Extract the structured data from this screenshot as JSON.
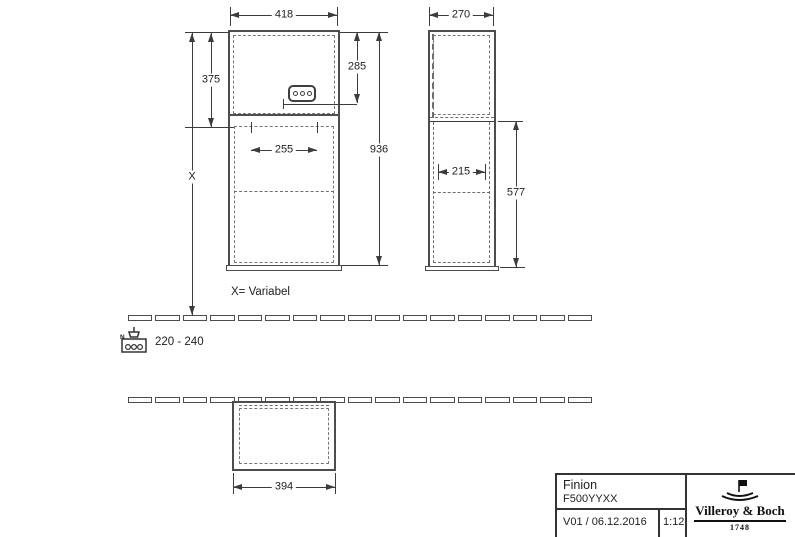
{
  "drawing": {
    "front_view": {
      "width": "418",
      "upper_section_height": "375",
      "socket_height": "285",
      "inner_width": "255",
      "total_height": "936",
      "variable_height": "X"
    },
    "side_view": {
      "depth": "270",
      "inner_depth": "215",
      "lower_section_height": "577"
    },
    "plan_view": {
      "width": "394"
    },
    "notes": {
      "variable_note": "X= Variabel",
      "voltage_range": "220 - 240",
      "neutral_label": "N"
    }
  },
  "title_block": {
    "product_name": "Finion",
    "product_code": "F500YYXX",
    "version_date": "V01 / 06.12.2016",
    "scale": "1:12",
    "brand_name": "Villeroy & Boch",
    "brand_year": "1748"
  },
  "colors": {
    "line": "#3c3c3c",
    "background": "#ffffff"
  }
}
